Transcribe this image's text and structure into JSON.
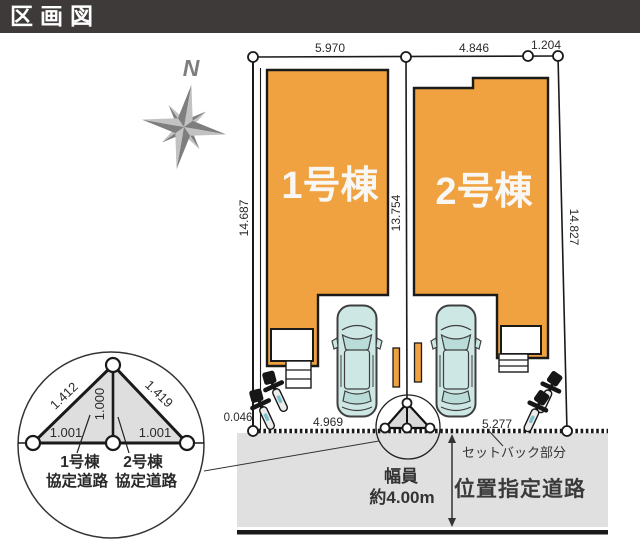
{
  "header": {
    "title": "区画図"
  },
  "compass": {
    "north_label": "N"
  },
  "dimensions": {
    "top": [
      "5.970",
      "4.846",
      "1.204"
    ],
    "left_side": "14.687",
    "center_side": "13.754",
    "right_side": "14.827",
    "bottom_offset": "0.046",
    "bottom_left": "4.969",
    "bottom_right": "5.277"
  },
  "buildings": [
    {
      "label": "1号棟"
    },
    {
      "label": "2号棟"
    }
  ],
  "road_detail": {
    "slope_left": "1.412",
    "slope_right": "1.419",
    "height": "1.000",
    "base_left": "1.001",
    "base_right": "1.001",
    "left_label_line1": "1号棟",
    "left_label_line2": "協定道路",
    "right_label_line1": "2号棟",
    "right_label_line2": "協定道路"
  },
  "road": {
    "width_line1": "幅員",
    "width_line2": "約4.00m",
    "setback_label": "セットバック部分",
    "name": "位置指定道路"
  },
  "colors": {
    "building": "#F0A240",
    "car": "#CDE7E4",
    "car_glass": "#B9DCD9",
    "road": "#E0E0E0",
    "detail_fill": "#DEDEDE",
    "header_bg": "#3E3A39",
    "compass": "#8B8B8B"
  }
}
